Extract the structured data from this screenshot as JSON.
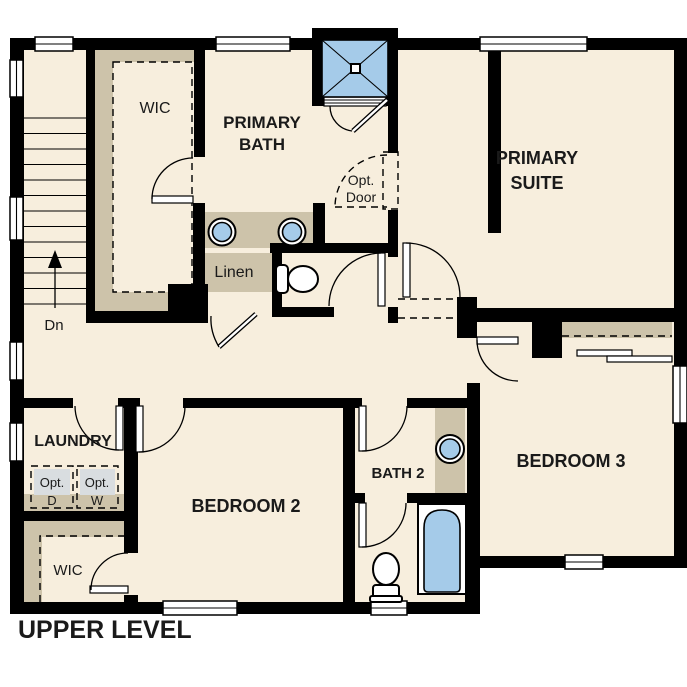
{
  "title": "UPPER LEVEL",
  "labels": {
    "primary_wic": "WIC",
    "primary_bath": [
      "PRIMARY",
      "BATH"
    ],
    "primary_suite": [
      "PRIMARY",
      "SUITE"
    ],
    "opt_door": [
      "Opt.",
      "Door"
    ],
    "linen": "Linen",
    "laundry": "LAUNDRY",
    "opt_dryer": [
      "Opt.",
      "D"
    ],
    "opt_washer": [
      "Opt.",
      "W"
    ],
    "bedroom_2": "BEDROOM 2",
    "bath_2": "BATH 2",
    "bedroom_3": "BEDROOM 3",
    "bedroom2_wic": "WIC",
    "stair_direction": "Dn"
  },
  "colors": {
    "floor": "#f7eedd",
    "closet_shelf": "#cdc3aa",
    "wall": "#000000",
    "fixture_blue": "#a5cbe9",
    "optional_appliance": "#d9dde0",
    "text": "#1a1a1a"
  }
}
